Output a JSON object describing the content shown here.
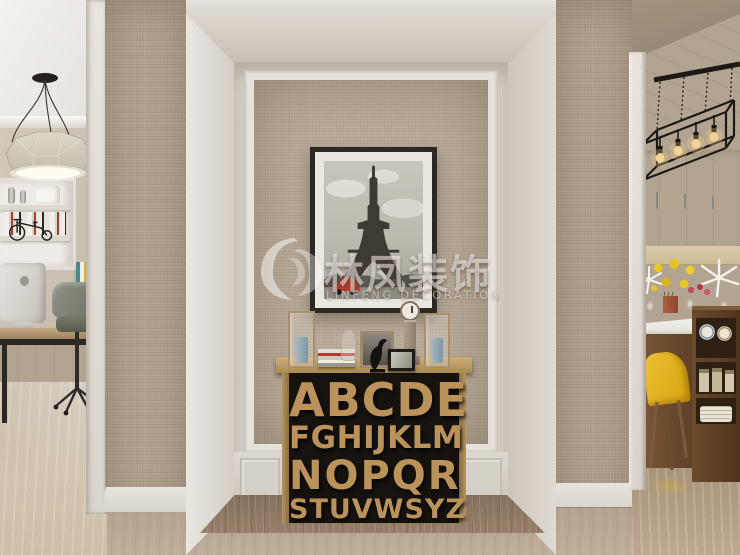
{
  "scene": {
    "description": "Interior render: hallway niche with alphabet console table and Eiffel Tower artwork, home office at left, dining room at right",
    "rooms": {
      "left": "home office with geometric pendant lamp, bookshelf, tricycle model, iMac desk and office chair",
      "center": "wallpapered niche with framed Eiffel Tower photo above wooden-letter console table",
      "right": "dining room with black frame chandelier, white cabinets, yellow lilies, yellow chair and wooden sideboard"
    }
  },
  "watermark": {
    "cn": "林凤装饰",
    "en": "LINFENG DECORATION",
    "logo": "phoenix-swirl-icon"
  },
  "alphabet_table": {
    "rows": [
      "ABCDE",
      "FGHIJKLM",
      "NOPQR",
      "STUVWSYZ"
    ]
  },
  "artwork": {
    "subject": "Eiffel Tower black-and-white photo",
    "accent": "red vintage car"
  },
  "decor_items": [
    "glass-lantern-left",
    "book-stack",
    "glass-vase",
    "framed-print",
    "bird-figurine",
    "mantel-clock",
    "black-photo-frame",
    "glass-lantern-right"
  ],
  "palette": {
    "wallpaper": "#b0a28e",
    "niche_wallpaper": "#b9ab99",
    "trim_white": "#e4e0d9",
    "letter_wood": "#bb9257",
    "table_black": "#16130f",
    "hall_floor": "#b1a08b",
    "niche_floor": "#8d7660",
    "car_red": "#b63b28",
    "flower_yellow": "#e4c51e",
    "chair_yellow": "#e0b018",
    "candle_blue": "#8ba3b0"
  }
}
